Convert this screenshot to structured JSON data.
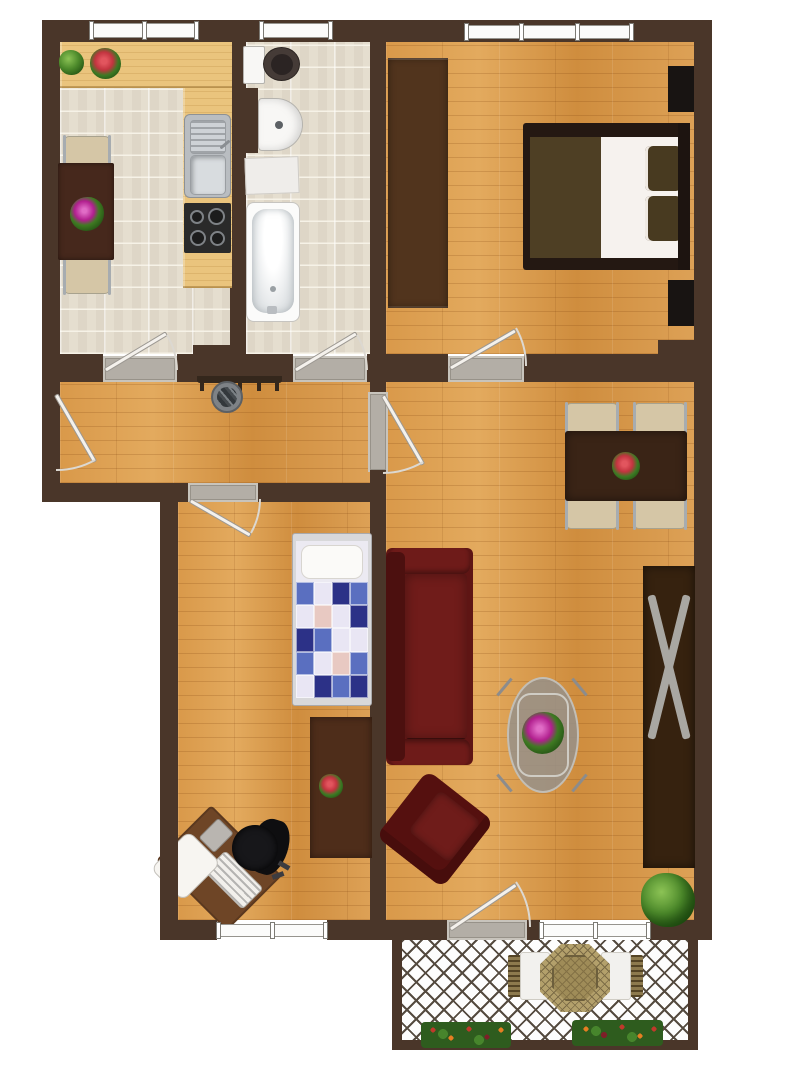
{
  "image_type": "apartment-floor-plan-top-view",
  "text_labels": [],
  "colors": {
    "wall": "#4a3629",
    "wood_floor": "#d99a4e",
    "tile_floor": "#e5decf",
    "counter_wood": "#eac47d",
    "dark_furniture": "#3a2416",
    "kitchen_table": "#46281c",
    "chair_beige": "#d5c6a6",
    "chrome": "#a7acb0",
    "white_fixture": "#f8f7f5",
    "toilet_seat_dark": "#453b37",
    "stove_black": "#2a2a2a",
    "sofa_red": "#5e1514",
    "sofa_red_light": "#701c1a",
    "bed_frame": "#241812",
    "blanket_olive": "#4e3f24",
    "pillow_olive": "#483a20",
    "mattress_white": "#f6f2ee",
    "wardrobe_brown": "#51341d",
    "child_sideboard": "#4e2d1a",
    "desk_brown": "#6e4526",
    "office_chair_black": "#17171a",
    "quilt_navy": "#2c3187",
    "quilt_blue": "#5a6fc0",
    "quilt_light": "#e9e6f4",
    "quilt_pink": "#e8c9c2",
    "glass_table": "#97918a",
    "plant_green": "#3c7a24",
    "flower_magenta": "#b11f8e",
    "flower_red": "#c2343f",
    "balcony_wicker": "#b3a06b",
    "lattice_line": "#554b40",
    "door_leaf": "#f4f1ec",
    "threshold": "#b3aea6",
    "window_white": "#fbfbfa"
  },
  "rooms": [
    {
      "id": "kitchen",
      "position": "top-left",
      "floor": "beige-tiles",
      "furniture": [
        "l-shaped-wood-counter",
        "double-basin-sink",
        "stove-four-burners",
        "dark-dining-table",
        "two-beige-chairs",
        "magenta-flower-pot",
        "green-plant",
        "red-flower-plant"
      ],
      "openings": [
        "window-top",
        "door-to-hallway"
      ]
    },
    {
      "id": "bathroom",
      "position": "top-middle",
      "floor": "beige-tiles",
      "furniture": [
        "toilet",
        "round-washbasin",
        "bath-mat",
        "bathtub"
      ],
      "openings": [
        "window-top",
        "door-to-hallway"
      ]
    },
    {
      "id": "bedroom",
      "position": "top-right",
      "floor": "wood-parquet",
      "furniture": [
        "long-wardrobe",
        "double-bed-with-olive-blanket",
        "two-pillows",
        "two-dark-nightstands"
      ],
      "openings": [
        "window-top",
        "door-to-living-room"
      ]
    },
    {
      "id": "hallway",
      "position": "middle",
      "floor": "wood-parquet",
      "furniture": [
        "coat-rack-with-hooks",
        "umbrella-stand"
      ],
      "openings": [
        "entry-door-left",
        "door-to-living-room"
      ]
    },
    {
      "id": "childrens-room",
      "position": "bottom-left",
      "floor": "wood-parquet",
      "furniture": [
        "single-bed-patchwork-quilt",
        "dark-sideboard",
        "small-red-flowers",
        "corner-desk-rotated",
        "black-office-chair"
      ],
      "openings": [
        "window-bottom",
        "door-to-hallway"
      ]
    },
    {
      "id": "living-room",
      "position": "middle-right",
      "floor": "wood-parquet",
      "furniture": [
        "dark-dining-table",
        "four-beige-chairs",
        "red-flower-centerpiece",
        "dark-red-sofa",
        "dark-red-armchair-rotated",
        "oval-glass-coffee-table",
        "magenta-plant",
        "dark-sideboard-with-x-frame",
        "corner-green-plant"
      ],
      "openings": [
        "window-bottom",
        "balcony-door",
        "door-to-hallway",
        "door-to-bedroom"
      ]
    },
    {
      "id": "balcony",
      "position": "bottom",
      "floor": "white-diamond-lattice",
      "furniture": [
        "octagonal-wicker-table",
        "two-seat-cushions",
        "two-flower-boxes"
      ],
      "openings": []
    }
  ]
}
